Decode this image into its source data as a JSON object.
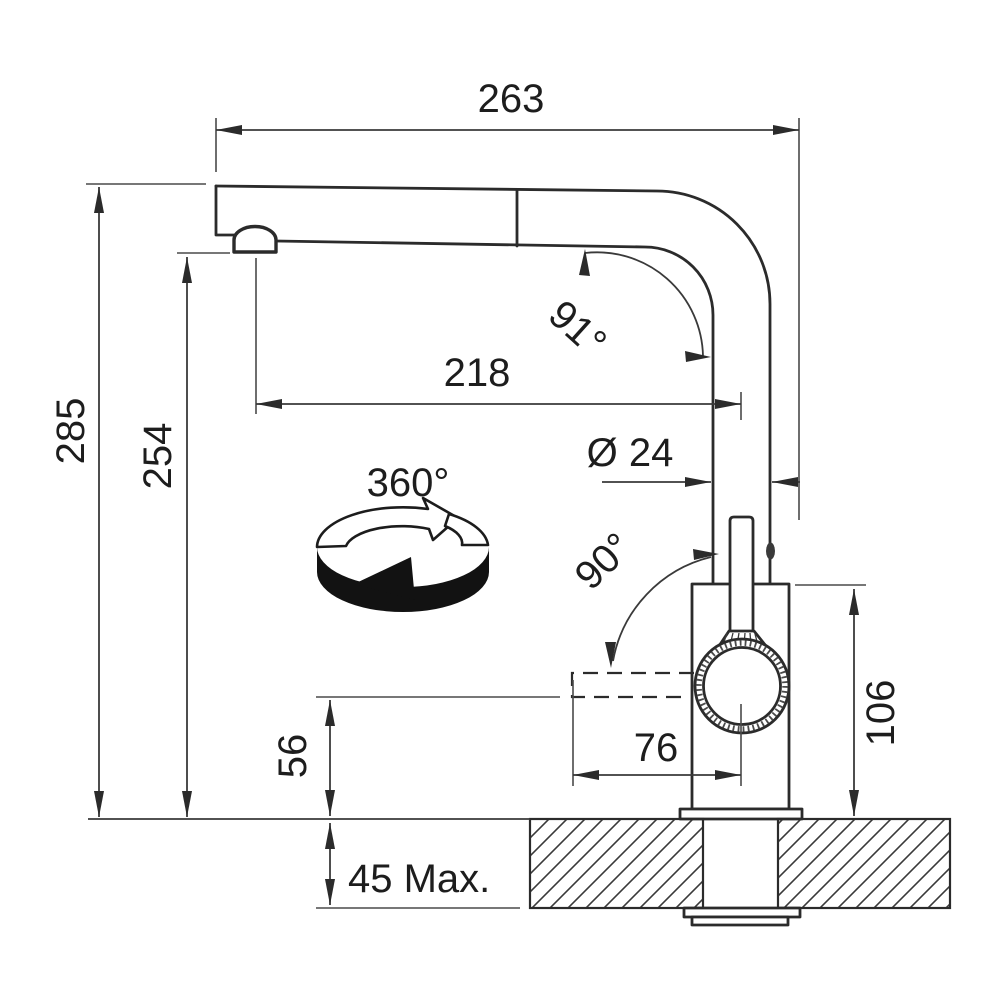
{
  "background": "#ffffff",
  "line_color": "#2b2b2b",
  "diagram": {
    "type": "technical-drawing",
    "subject": "pull-out kitchen mixer tap side view with installation dimensions (mm)",
    "labels": {
      "overall_width": "263",
      "overall_height": "285",
      "spout_height": "254",
      "spout_reach": "218",
      "spout_angle": "91°",
      "spout_diameter": "Ø 24",
      "swivel_range": "360°",
      "handle_angle": "90°",
      "body_height": "106",
      "handle_reach": "76",
      "handle_clearance": "56",
      "deck_thickness_max": "45 Max."
    }
  }
}
